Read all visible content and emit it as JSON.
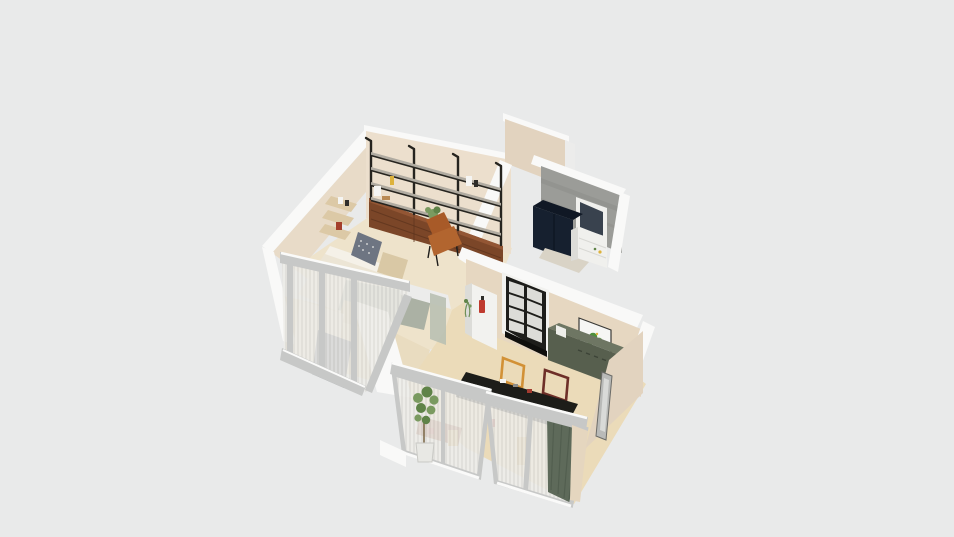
{
  "viewport": {
    "kind": "3d-floorplan-dollhouse-render",
    "width": 954,
    "height": 537
  },
  "scene": {
    "rooms": [
      {
        "name": "studio-room",
        "objects": [
          "wall-shelving-3-bays",
          "walnut-low-cabinets",
          "cognac-lounge-chair",
          "corner-wall-shelf-with-books",
          "bed-with-patterned-pillow",
          "sage-rug",
          "bed-bench",
          "shelf-plant",
          "shelf-decor"
        ]
      },
      {
        "name": "utility-room",
        "objects": [
          "concrete-walls",
          "navy-double-wardrobe",
          "white-tall-cabinet",
          "interior-window"
        ]
      },
      {
        "name": "kitchen-living-room",
        "objects": [
          "black-framed-glazed-door",
          "white-doorway-cabinet",
          "fire-extinguisher",
          "botanical-art-print",
          "dark-green-sideboard",
          "black-kitchen-island",
          "leaning-frame-orange",
          "leaning-frame-maroon",
          "floor-mirror"
        ]
      },
      {
        "name": "balcony-glazing",
        "objects": [
          "sliding-glass-door-left",
          "sliding-glass-door-right",
          "sheer-curtains",
          "dark-green-curtain",
          "tall-potted-plant"
        ]
      },
      {
        "name": "bedroom-window-bay",
        "objects": [
          "corner-glazing",
          "sheer-curtains",
          "window-lintel"
        ]
      }
    ]
  },
  "colors": {
    "background": "#e9eaea",
    "floor_study": "#eee3cb",
    "floor_study_warm": "#e9dcc0",
    "floor_kitchen": "#ebdbb9",
    "wall_white": "#f9f9f8",
    "wall_white_shade": "#ececeb",
    "wall_beige": "#e8dbc8",
    "wall_beige_light": "#ecdfcd",
    "wall_beige_dark": "#e2d3bf",
    "wall_beige_kitchen": "#e6d7c1",
    "concrete": "#9b9c98",
    "concrete_dark": "#8d8e8a",
    "window_glass_dark": "#39424e",
    "window_glass_light": "#7d848d",
    "navy": "#16202f",
    "navy_dark": "#101825",
    "cabinet_white": "#f0f0ed",
    "cabinet_side": "#dcdcd8",
    "utility_floor": "#d9d3c6",
    "walnut": "#7b4628",
    "walnut_light": "#935634",
    "shelf_board": "#b0aba1",
    "shelf_frame": "#26241f",
    "chair_seat": "#b2652f",
    "chair_back": "#a85a28",
    "bed_white": "#ece5d5",
    "bed_head": "#f5f1e8",
    "pillow": "#6e7582",
    "rug": "#abb1a4",
    "bench": "#d9c8a5",
    "corner_shelf_wood": "#dcc9a6",
    "book_red": "#a43f2c",
    "door_black": "#1d1d1a",
    "door_pane": "#dcdcd8",
    "counter_white": "#f2f2ef",
    "red_item": "#bf3a2e",
    "print_frame": "#f6f6f4",
    "print_green": "#4e8f3c",
    "print_green2": "#66a34b",
    "counter_green": "#575f4e",
    "counter_green_top": "#6e7663",
    "appliance_white": "#eeeeea",
    "frame_orange": "#d29136",
    "frame_maroon": "#6e2f28",
    "island": "#1d1d19",
    "island_dark": "#0f0f0d",
    "frame_gray": "#c7c8c7",
    "curtain_green": "#5e6a5a",
    "plant_green": "#7a9a60",
    "plant_dark": "#5f8348",
    "pot_white": "#e8e8e4",
    "mirror_gray": "#b9bab8",
    "mirror_face": "#d9dad8",
    "hint_tan": "#d8b06a",
    "hint_red": "#a33b30",
    "hint_brown": "#9b5a3f",
    "sage_sliver": "#b9c0b2",
    "beige_sliver": "#e5d6bf",
    "stripe_bg": "#edece8",
    "stripe_line": "#d8d7d2",
    "decor_yellow": "#ddb23c",
    "decor_white": "#f5f5f3",
    "decor_black": "#2e2d2a",
    "pot_terracotta": "#b98a55"
  }
}
